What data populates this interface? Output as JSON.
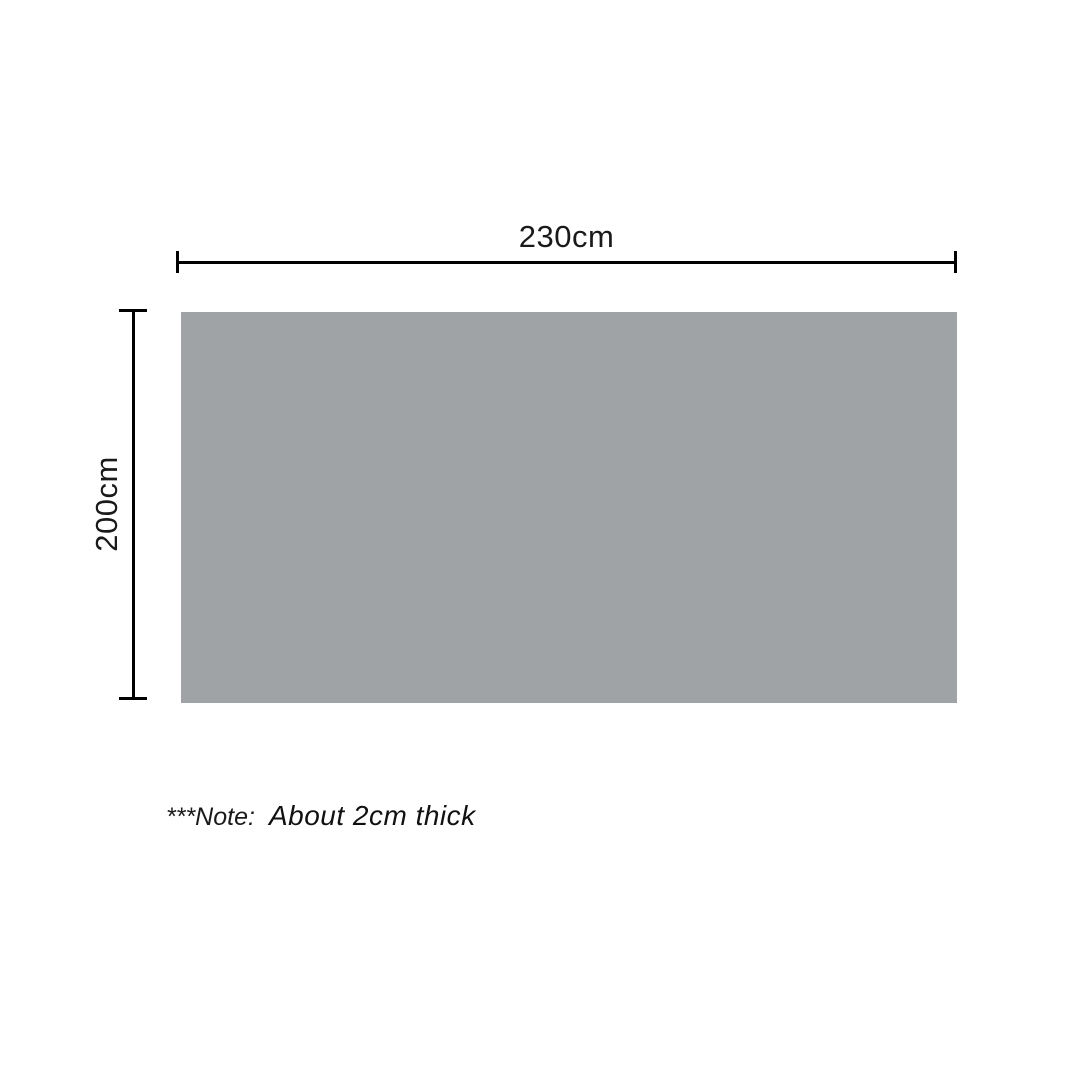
{
  "diagram": {
    "title": "product-dimension-diagram",
    "width_dimension": {
      "label": "230cm"
    },
    "height_dimension": {
      "label": "200cm"
    },
    "note": {
      "prefix": "***Note:",
      "text": "About 2cm thick"
    },
    "colors": {
      "panel_fill": "#a0a3a5",
      "dimension_line": "#000000",
      "text": "#1a1a1a",
      "background": "#ffffff"
    }
  }
}
